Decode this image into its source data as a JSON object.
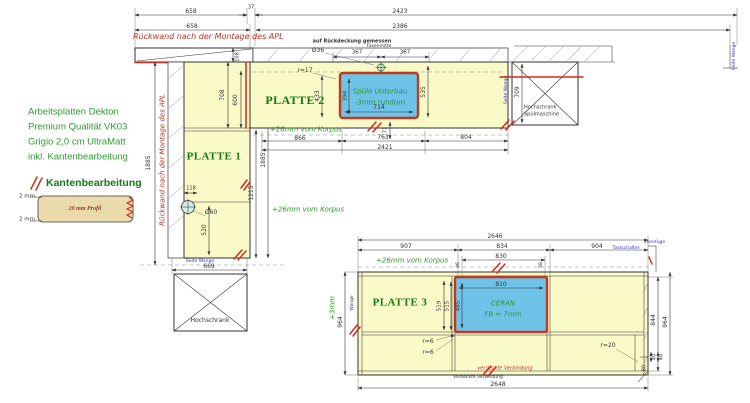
{
  "info": [
    "Arbeitsplatten Dekton",
    "Premium Qualität VK03",
    "Grigio 2,0 cm UltraMatt",
    "inkl. Kantenbearbeitung"
  ],
  "legend": {
    "title": "Kantenbearbeitung",
    "profile": "20 mm Profil",
    "edge_top": "2 mm",
    "edge_bottom": "2 mm"
  },
  "notes": {
    "rueckwand_top": "Rückwand nach der Montage des APL",
    "rueckwand_left": "Rückwand nach der Montage des APL",
    "rueckdeckung": "auf Rückdeckung gemessen",
    "fasenmitte": "Fasenmitte",
    "verdeckte_rot": "verdeckte Verbindung",
    "verdeckte_schwarz": "Verdeckte Verbindung"
  },
  "top_dims": {
    "left1": "658",
    "step": "37",
    "total1": "2423",
    "left2": "658",
    "total2": "2386"
  },
  "p1": {
    "label": "PLATTE 1",
    "h_total_left": "1885",
    "h_total_right": "1885",
    "h_lower": "1215",
    "hole_offset": "118",
    "hole_dia": "Ø60",
    "hole_height": "520",
    "width_bottom": "669",
    "korpus": "+26mm vom Korpus",
    "seite_wange": "Seite Wange",
    "cabinet": "Hochschrank"
  },
  "p2": {
    "label": "PLATTE 2",
    "corner_h1": "708",
    "corner_h2": "600",
    "corner_h3": "108",
    "faucet_dia": "Ø36",
    "faucet_left": "367",
    "faucet_right": "367",
    "radius": "r=17",
    "sink_line1": "Spüle Unterbau",
    "sink_line2": "-3mm rundum",
    "sink_width": "714",
    "sink_h_inner": "394",
    "sink_h_left": "433",
    "sink_h_right": "535",
    "edge_gap": "71",
    "seg1": "866",
    "seg2": "763",
    "seg3": "804",
    "total": "2421",
    "korpus": "+26mm vom Korpus"
  },
  "tower": {
    "line1": "Hochschrank",
    "line2": "Spülmaschine",
    "depth": "709",
    "seite_wange": "Seite Wange"
  },
  "wall_right": {
    "seite_wange": "Seite Wange"
  },
  "p3": {
    "label": "PLATTE 3",
    "total_top": "2646",
    "seg1": "907",
    "seg2": "834",
    "seg3": "904",
    "hob_zone": "830",
    "inset_left": "46",
    "inset_right": "58",
    "hob_width": "810",
    "hob_height": "485",
    "h1": "519",
    "h2": "515",
    "depth_left": "964",
    "plus3": "+3mm",
    "depth_right": "964",
    "depth_inner": "844",
    "total_bottom": "2648",
    "r6a": "r=6",
    "r6b": "r=6",
    "r20": "r=20",
    "n40a": "40",
    "n40b": "40",
    "n80": "80",
    "ceran1": "CERAN",
    "ceran2": "FB = 7mm",
    "korpus": "+26mm vom Korpus",
    "wange": "Wange",
    "trennfuge": "Trennfuge",
    "tastschalter": "Tastschalter"
  },
  "colors": {
    "plate_fill": "#FAFAC9",
    "cutout_fill": "#6FC2E8",
    "cutout_border": "#C2391A",
    "edge_mark": "#D22B1F",
    "text_green": "#2C9A2C",
    "label_green": "#147814",
    "note_red": "#C03026",
    "label_blue": "#3333BB"
  }
}
